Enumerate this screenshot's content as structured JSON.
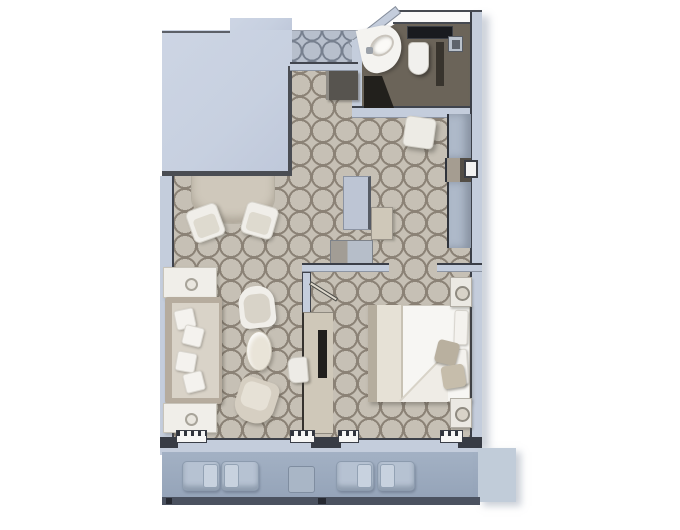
{
  "title": "suite-floor-plan",
  "palette": {
    "background": "#ffffff",
    "block": "#c7d0e0",
    "block-edge": "#4a4d53",
    "wall": "#c4cddc",
    "wall-edge": "#3d424b",
    "carpet": "#c6c0b5",
    "carpet-line": "#8b8276",
    "corridor-carpet": "#b7bfcc",
    "corridor-line": "#77808f",
    "bath-floor": "#6b6459",
    "dark-fixture": "#1c1b18",
    "white-furniture": "#f0eee9",
    "furniture-edge": "#c8c4ba",
    "taupe": "#b6ac9e",
    "taupe-light": "#d9d3c8",
    "beige-unit": "#cfc8b9",
    "tv-black": "#201f1d",
    "closet": "#aeb9c9",
    "deck": "#9cabbf",
    "deck-light": "#c1ccd9",
    "lounger": "#b6c2d2",
    "railing": "#4b5260",
    "bed-white": "#f7f6f3",
    "blanket": "#e6e1d6",
    "cushion": "#bdb4a3"
  },
  "rooms": {
    "corridor": {
      "items": [
        "corridor-carpet"
      ]
    },
    "entry": {
      "items": [
        "entry-bench"
      ]
    },
    "bathroom": {
      "items": [
        "vanity-sink",
        "faucet",
        "toilet",
        "counter",
        "shower-fixture",
        "shower-partition",
        "floor-mat"
      ]
    },
    "dressing-area": {
      "items": [
        "stool",
        "closet-top",
        "closet-niche",
        "safe-box",
        "closet-bottom",
        "wardrobe",
        "tall-beige-unit",
        "low-cabinet"
      ]
    },
    "living-room": {
      "items": [
        "half-round-table",
        "side-chair-1",
        "side-chair-2",
        "end-table-1",
        "sofa",
        "sofa-pillows",
        "end-table-2",
        "armchair-1",
        "oval-coffee-table",
        "armchair-2",
        "desk-unit",
        "tv",
        "desk-chair"
      ]
    },
    "bedroom": {
      "items": [
        "double-bed",
        "blanket-runner",
        "pillows",
        "accent-cushions",
        "nightstand-1",
        "nightstand-2",
        "door-leaf"
      ]
    },
    "balcony": {
      "items": [
        "lounger-1",
        "lounger-2",
        "balcony-table",
        "lounger-3",
        "lounger-4",
        "railing",
        "deck-extension"
      ]
    }
  }
}
